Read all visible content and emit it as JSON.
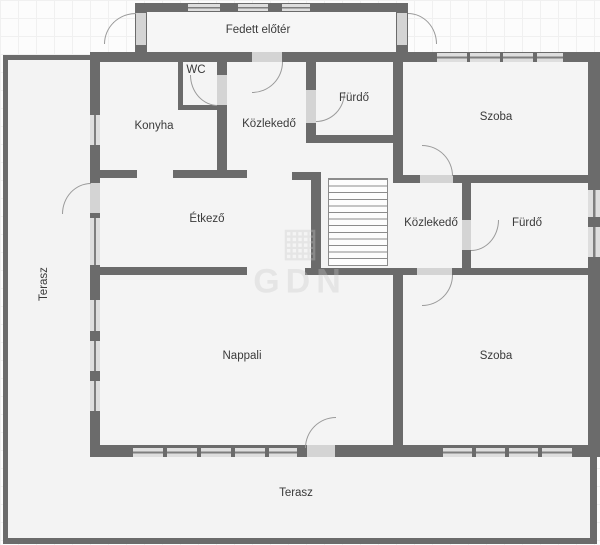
{
  "rooms": {
    "fedett_eloter": "Fedett előtér",
    "wc": "WC",
    "konyha": "Konyha",
    "kozlekedo_top": "Közlekedő",
    "furdo_top": "Fürdő",
    "szoba_top": "Szoba",
    "etkezo": "Étkező",
    "kozlekedo_mid": "Közlekedő",
    "furdo_mid": "Fürdő",
    "nappali": "Nappali",
    "szoba_bottom": "Szoba",
    "terasz_left": "Terasz",
    "terasz_bottom": "Terasz"
  },
  "watermark": "GDN",
  "colors": {
    "wall": "#6b6b6b",
    "room_fill": "#f4f4f4",
    "terrace_fill": "#f3f3f3",
    "door": "#d4d4d4",
    "window": "#dedede",
    "arc_stroke": "#9a9a9a",
    "label_text": "#3a3a3a",
    "background": "#fcfcfc"
  }
}
